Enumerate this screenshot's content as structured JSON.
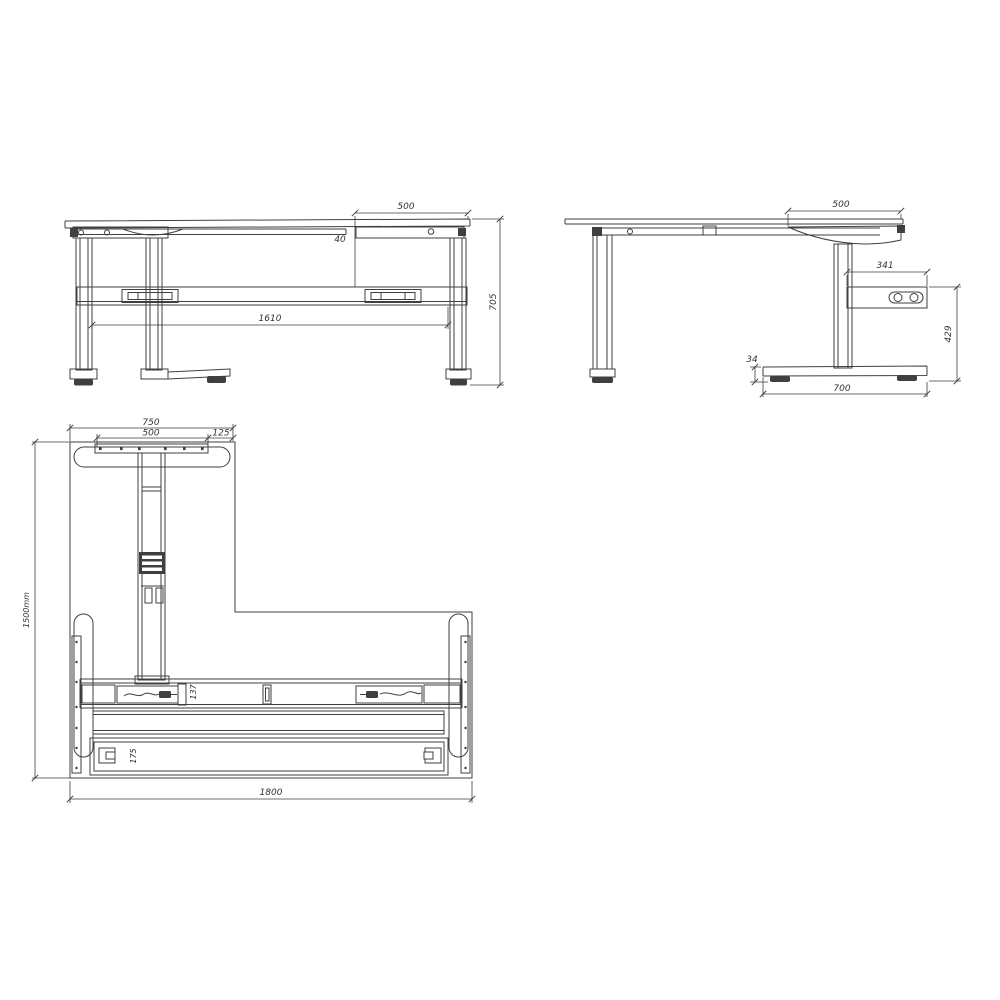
{
  "colors": {
    "line": "#3f3f3f",
    "text": "#333333",
    "background": "#ffffff"
  },
  "views": {
    "front_elevation": {
      "dims": {
        "top_right_overhang": "500",
        "rail_gap": "40",
        "frame_width": "1610",
        "overall_height": "705"
      }
    },
    "side_elevation": {
      "dims": {
        "top_depth": "500",
        "control_box_length": "341",
        "control_box_to_floor": "429",
        "foot_height": "34",
        "foot_length": "700"
      }
    },
    "plan": {
      "dims": {
        "return_top_width": "750",
        "mounting_bracket_width": "500",
        "bracket_edge_offset": "125",
        "overall_depth": "1500mm",
        "overall_width": "1800",
        "beam_width": "137",
        "rail_depth": "175"
      }
    }
  }
}
